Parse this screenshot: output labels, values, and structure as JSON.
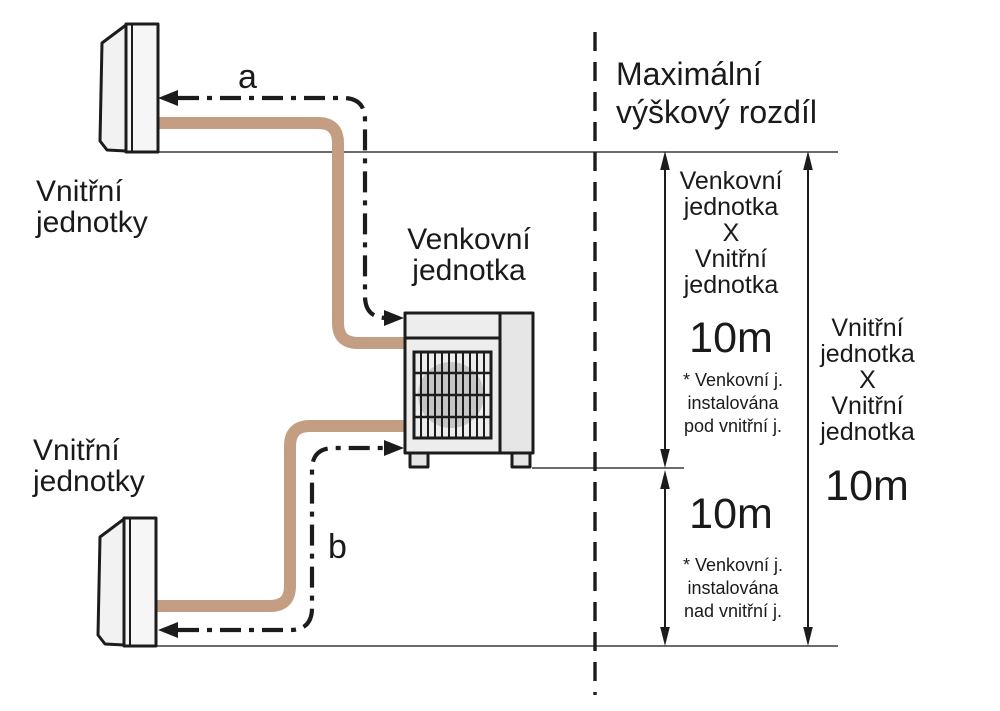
{
  "colors": {
    "pipe": "#c49e82",
    "line": "#1c1c1c",
    "unit_fill": "#f2f2f2",
    "unit_side": "#e6e6e6",
    "fan": "#c6c6c6",
    "text": "#1a1a1a"
  },
  "title": "Maximální\nvýškový rozdíl",
  "labels": {
    "indoor_top": "Vnitřní\njednotky",
    "indoor_bottom": "Vnitřní\njednotky",
    "outdoor": "Venkovní\njednotka",
    "line_a": "a",
    "line_b": "b"
  },
  "measurements": {
    "outdoor_indoor": {
      "header": "Venkovní\njednotka\nX\nVnitřní\njednotka",
      "above": {
        "value": "10m",
        "note": "* Venkovní j.\ninstalována\npod vnitřní j."
      },
      "below": {
        "value": "10m",
        "note": "* Venkovní j.\ninstalována\nnad vnitřní j."
      }
    },
    "indoor_indoor": {
      "header": "Vnitřní\njednotka\nX\nVnitřní\njednotka",
      "value": "10m"
    }
  }
}
